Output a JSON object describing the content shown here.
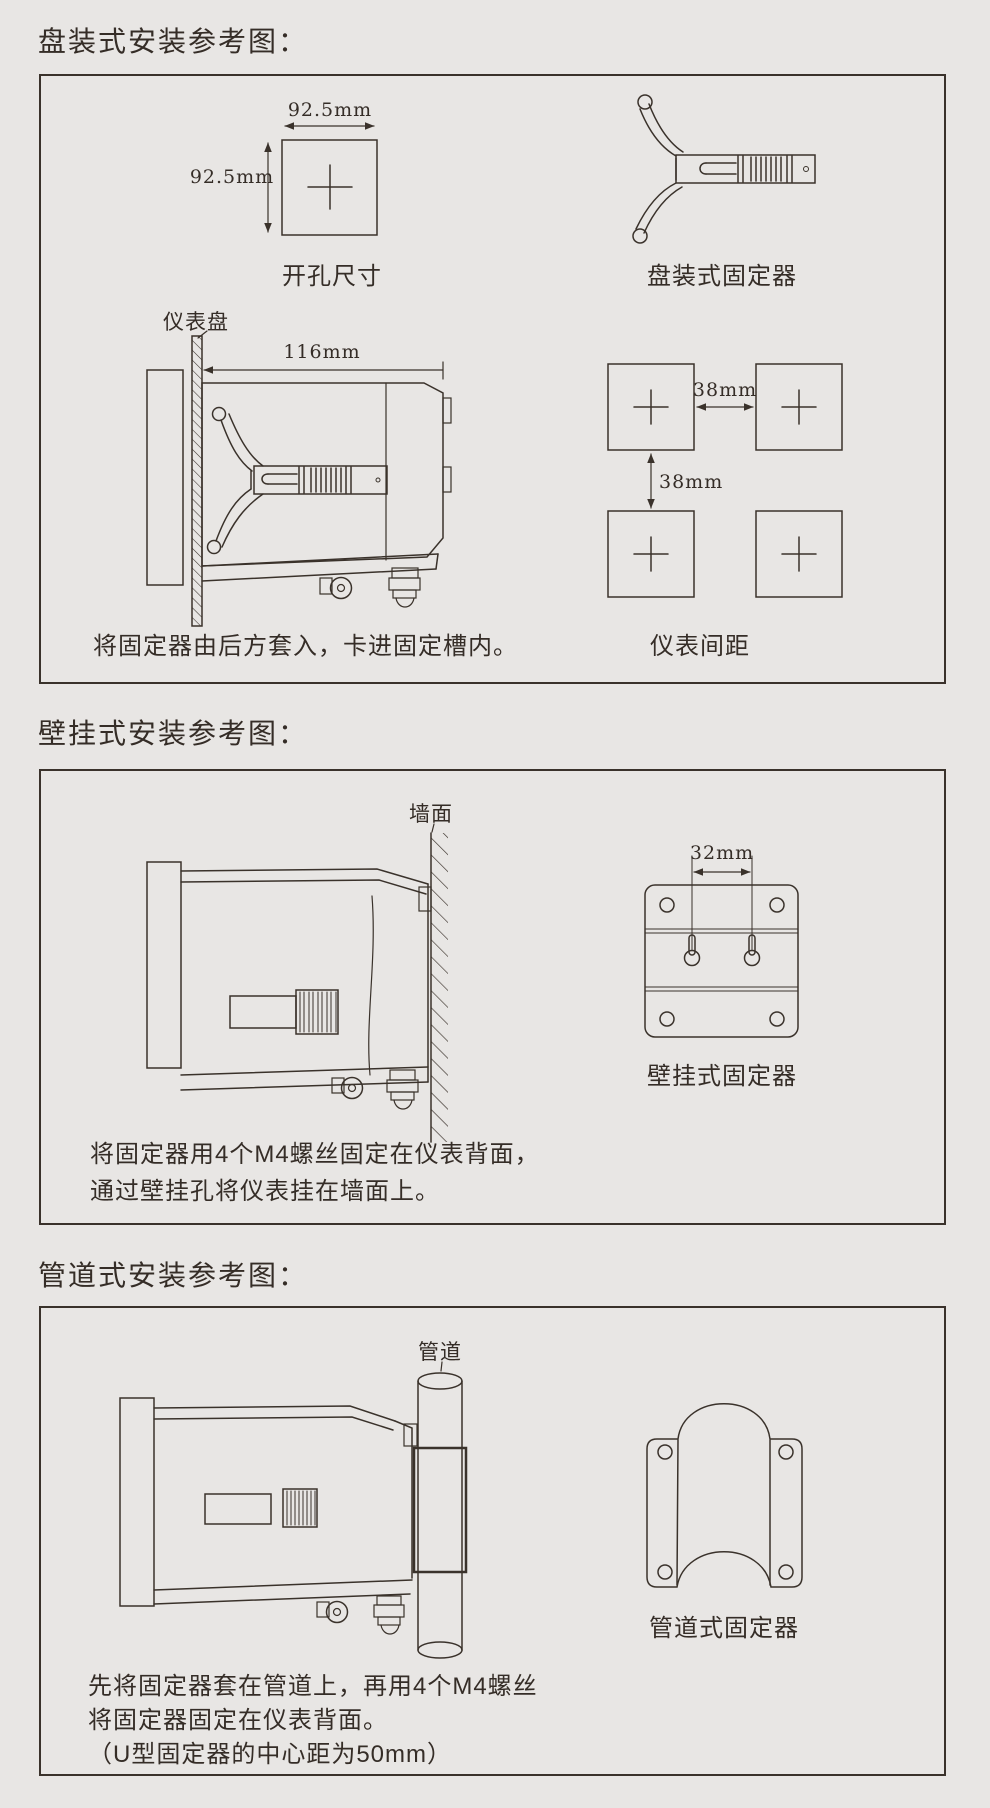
{
  "theme": {
    "background": "#e8e6e4",
    "line_color": "#3a322b",
    "text_color": "#352d27"
  },
  "sections": {
    "panel": {
      "title": "盘装式安装参考图：",
      "cutout": {
        "width_label": "92.5mm",
        "height_label": "92.5mm",
        "caption": "开孔尺寸"
      },
      "fixer_caption": "盘装式固定器",
      "panel_label": "仪表盘",
      "depth_label": "116mm",
      "instruction": "将固定器由后方套入，卡进固定槽内。",
      "spacing": {
        "h_label": "38mm",
        "v_label": "38mm",
        "caption": "仪表间距"
      }
    },
    "wall": {
      "title": "壁挂式安装参考图：",
      "wall_label": "墙面",
      "hole_spacing_label": "32mm",
      "fixer_caption": "壁挂式固定器",
      "instruction_line1": "将固定器用4个M4螺丝固定在仪表背面，",
      "instruction_line2": "通过壁挂孔将仪表挂在墙面上。"
    },
    "pipe": {
      "title": "管道式安装参考图：",
      "pipe_label": "管道",
      "fixer_caption": "管道式固定器",
      "instruction_line1": "先将固定器套在管道上，再用4个M4螺丝",
      "instruction_line2": "将固定器固定在仪表背面。",
      "instruction_line3": "（U型固定器的中心距为50mm）"
    }
  }
}
